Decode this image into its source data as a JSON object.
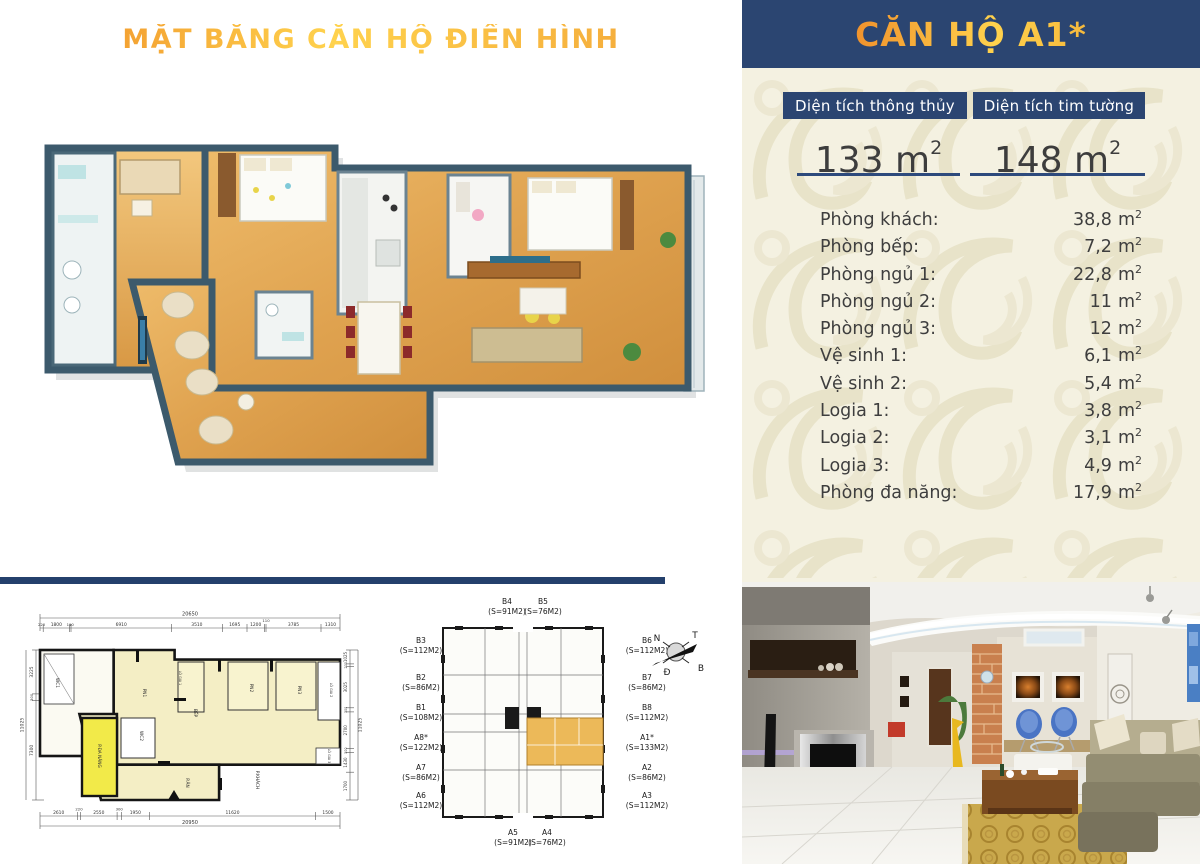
{
  "title": "MẶT BẰNG CĂN HỘ ĐIỂN HÌNH",
  "colors": {
    "navy": "#2b4571",
    "accent_orange": "#ef8f28",
    "accent_yellow": "#ffd24d",
    "panel_bg": "#f4f1e1",
    "swirl": "#e8e3c9",
    "highlight_unit": "#ecb959",
    "plan_wall_teal": "#3c5a6c",
    "plan_floor_wood": "#e2a853"
  },
  "panel": {
    "header": "CĂN HỘ A1*",
    "unit": "m",
    "unit_sup": "2",
    "metrics": [
      {
        "label": "Diện tích thông thủy",
        "value": "133"
      },
      {
        "label": "Diện tích tim tường",
        "value": "148"
      }
    ],
    "rooms": [
      {
        "name": "Phòng khách:",
        "value": "38,8"
      },
      {
        "name": "Phòng bếp:",
        "value": "7,2"
      },
      {
        "name": "Phòng ngủ 1:",
        "value": "22,8"
      },
      {
        "name": "Phòng ngủ 2:",
        "value": "11"
      },
      {
        "name": "Phòng ngủ 3:",
        "value": "12"
      },
      {
        "name": "Vệ sinh 1:",
        "value": "6,1"
      },
      {
        "name": "Vệ sinh 2:",
        "value": "5,4"
      },
      {
        "name": "Logia 1:",
        "value": "3,8"
      },
      {
        "name": "Logia 2:",
        "value": "3,1"
      },
      {
        "name": "Logia 3:",
        "value": "4,9"
      },
      {
        "name": "Phòng đa năng:",
        "value": "17,9"
      }
    ]
  },
  "plan2d": {
    "room_labels": [
      "WC1",
      "PN1",
      "LÔ GIA 1",
      "BẾP",
      "PN2",
      "PN3",
      "LÔ GIA 2",
      "WC2",
      "P.ĂN",
      "P.KHÁCH",
      "LÔ GIA 3",
      "P.ĐA NĂNG"
    ],
    "dims_top": {
      "total": "20650",
      "segments": [
        "220",
        "1800",
        "110",
        "6910",
        "3510",
        "1695",
        "1200",
        "110",
        "3785",
        "1310"
      ]
    },
    "dims_bottom": {
      "total": "20950",
      "segments": [
        "2610",
        "220",
        "2550",
        "300",
        "1950",
        "11620",
        "1500"
      ]
    },
    "dims_left": {
      "total": "11025",
      "segments": [
        "3225",
        "500",
        "7300"
      ]
    },
    "dims_right": {
      "total": "11025",
      "segments": [
        "1025",
        "200",
        "3025",
        "300",
        "2700",
        "300",
        "1430",
        "1700"
      ]
    }
  },
  "keyplan": {
    "top": [
      {
        "label": "B4",
        "area": "(S=91M2)"
      },
      {
        "label": "B5",
        "area": "(S=76M2)"
      }
    ],
    "left": [
      {
        "label": "B3",
        "area": "(S=112M2)"
      },
      {
        "label": "B2",
        "area": "(S=86M2)"
      },
      {
        "label": "B1",
        "area": "(S=108M2)"
      },
      {
        "label": "A8*",
        "area": "(S=122M2)"
      },
      {
        "label": "A7",
        "area": "(S=86M2)"
      },
      {
        "label": "A6",
        "area": "(S=112M2)"
      }
    ],
    "right": [
      {
        "label": "B6",
        "area": "(S=112M2)"
      },
      {
        "label": "B7",
        "area": "(S=86M2)"
      },
      {
        "label": "B8",
        "area": "(S=112M2)"
      },
      {
        "label": "A1*",
        "area": "(S=133M2)"
      },
      {
        "label": "A2",
        "area": "(S=86M2)"
      },
      {
        "label": "A3",
        "area": "(S=112M2)"
      }
    ],
    "bottom": [
      {
        "label": "A5",
        "area": "(S=91M2)"
      },
      {
        "label": "A4",
        "area": "(S=76M2)"
      }
    ],
    "compass": {
      "n": "N",
      "t": "T",
      "d": "Đ",
      "b": "B"
    }
  }
}
